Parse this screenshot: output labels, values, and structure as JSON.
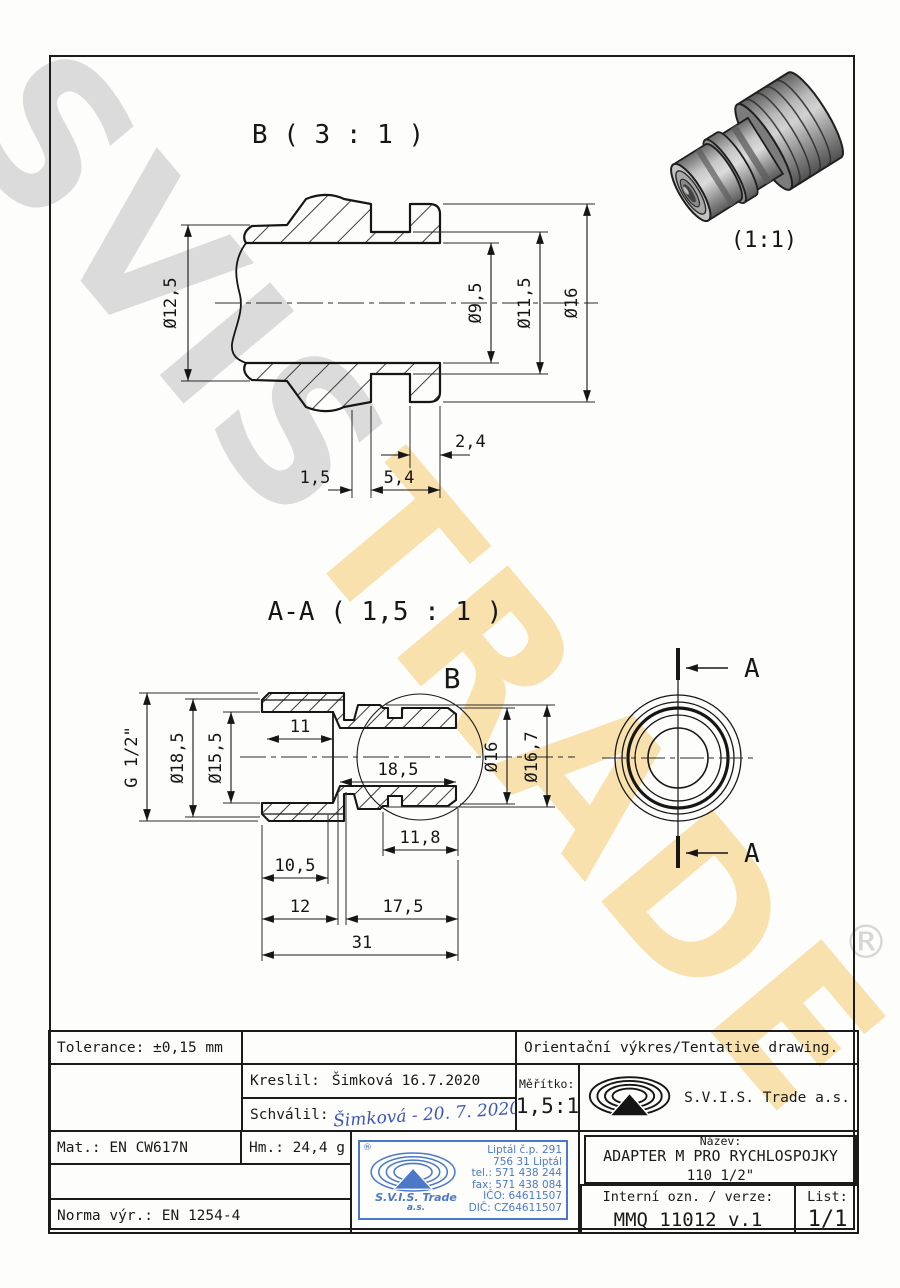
{
  "watermark": {
    "part1": "SVIS",
    "part2": "TRADE",
    "registered_mark": "®",
    "gray": "#7d7d7d",
    "yellow": "#f4b941"
  },
  "views": {
    "detail_b": {
      "title": "B ( 3 : 1 )",
      "dims": {
        "d125": "Ø12,5",
        "d95": "Ø9,5",
        "d115": "Ø11,5",
        "d16": "Ø16",
        "l24": "2,4",
        "l15": "1,5",
        "l54": "5,4"
      }
    },
    "photo": {
      "label": "(1:1)"
    },
    "section_aa": {
      "title": "A-A ( 1,5 : 1 )",
      "detail_marker": "B",
      "dims": {
        "g": "G 1/2\"",
        "d185": "Ø18,5",
        "d155": "Ø15,5",
        "l11": "11",
        "li185": "18,5",
        "d16": "Ø16",
        "d167": "Ø16,7",
        "l118": "11,8",
        "l105": "10,5",
        "l12": "12",
        "l175": "17,5",
        "l31": "31"
      }
    },
    "end_view": {
      "cut_label": "A"
    }
  },
  "title_block": {
    "tolerance": "Tolerance: ±0,15 mm",
    "drawing_note": "Orientační výkres/Tentative drawing.",
    "kreslil_label": "Kreslil:",
    "kreslil_value": "Šimková 16.7.2020",
    "schvalil_label": "Schválil:",
    "schvalil_signature": "Šimková - 20. 7. 2020",
    "meritko_label": "Měřítko:",
    "meritko_value": "1,5:1",
    "company": "S.V.I.S. Trade a.s.",
    "mat": "Mat.: EN CW617N",
    "hm": "Hm.: 24,4 g",
    "norma": "Norma výr.: EN 1254-4",
    "nazev_label": "Název:",
    "nazev_line1": "ADAPTER M PRO RYCHLOSPOJKY",
    "nazev_line2": "110 1/2\"",
    "interni_label": "Interní ozn. / verze:",
    "interni_value": "MMQ 11012 v.1",
    "list_label": "List:",
    "list_value": "1/1"
  },
  "stamp": {
    "registered": "®",
    "company_line1": "S.V.I.S. Trade",
    "company_line2": "a.s.",
    "address": [
      "Liptál č.p. 291",
      "756 31 Liptál",
      "tel.: 571 438 244",
      "fax: 571 438 084",
      "IČO: 64611507",
      "DIČ: CZ64611507"
    ],
    "color": "#4b79c7"
  }
}
